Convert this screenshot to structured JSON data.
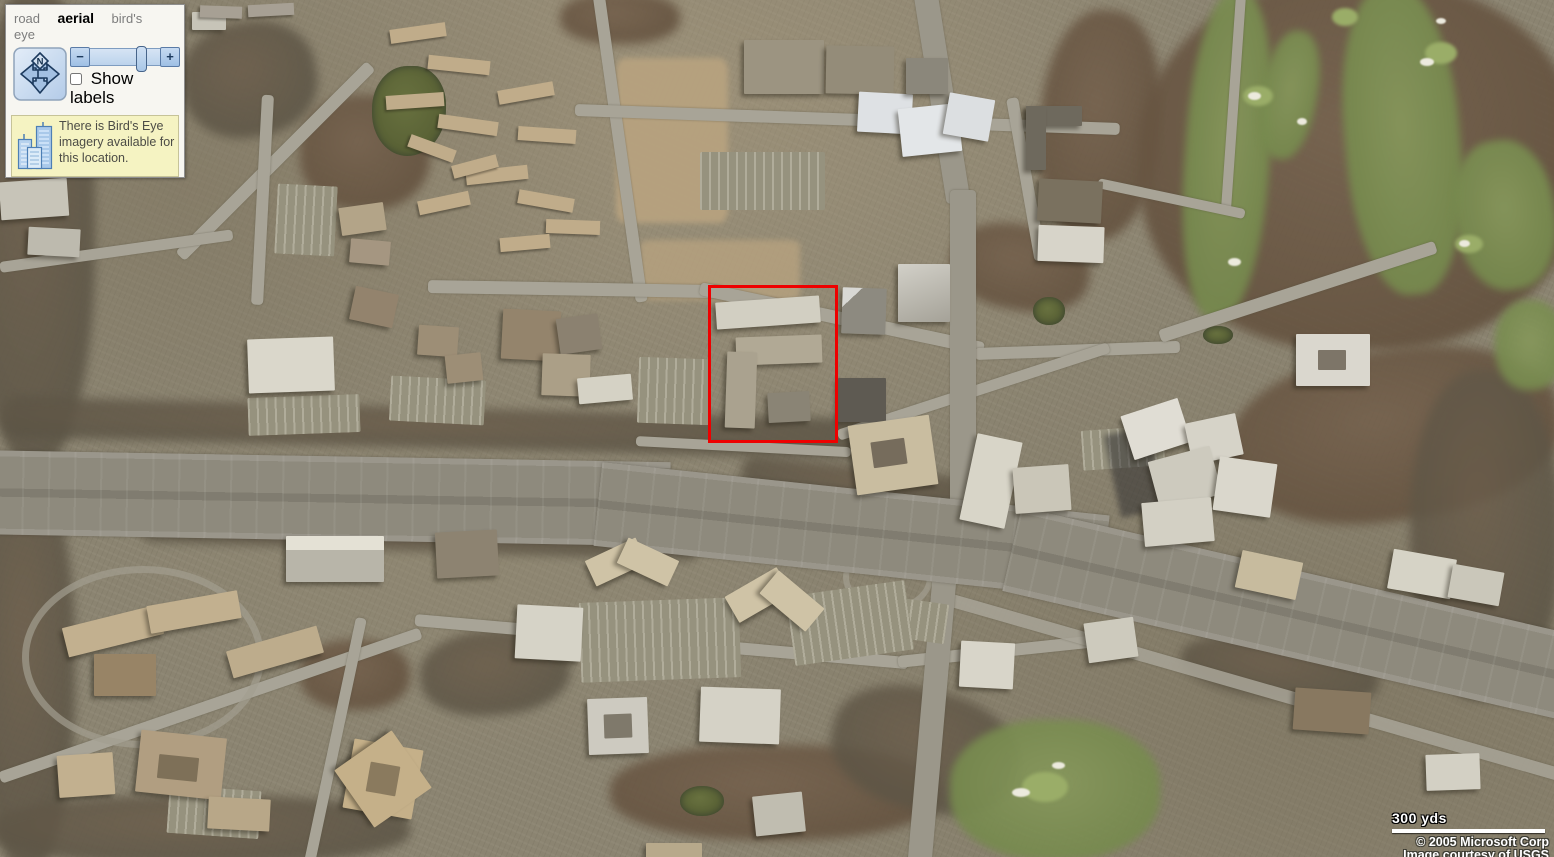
{
  "controls": {
    "tabs": [
      {
        "id": "road",
        "label": "road",
        "active": false
      },
      {
        "id": "aerial",
        "label": "aerial",
        "active": true
      },
      {
        "id": "birds-eye",
        "label": "bird's eye",
        "active": false
      }
    ],
    "compass": {
      "north_label": "N"
    },
    "zoom_slider": {
      "zoom_out_label": "−",
      "zoom_in_label": "+"
    },
    "show_labels": {
      "label": "Show labels",
      "checked": false
    },
    "notice": {
      "text": "There is Bird's Eye imagery available for this location.",
      "icon": "birdseye-buildings-icon"
    }
  },
  "map": {
    "mode": "aerial",
    "highlight_box": {
      "left_px": 708,
      "top_px": 285,
      "width_px": 124,
      "height_px": 152,
      "color": "#ee0000"
    }
  },
  "scale_bar": {
    "label": "300 yds"
  },
  "attribution": {
    "line1": "© 2005 Microsoft Corp",
    "line2": "Image courtesy of USGS"
  },
  "colors": {
    "highlight_red": "#ee0000",
    "panel_background": "#f7f6f1",
    "notice_background": "#f5f3c2",
    "control_blue": "#a9c7e7",
    "terrain_base": "#8b8471",
    "golf_green": "#7e9254",
    "highway_gray": "#8e8a7d",
    "building_light": "#dcd9ce",
    "tree_dark": "#64584a"
  }
}
